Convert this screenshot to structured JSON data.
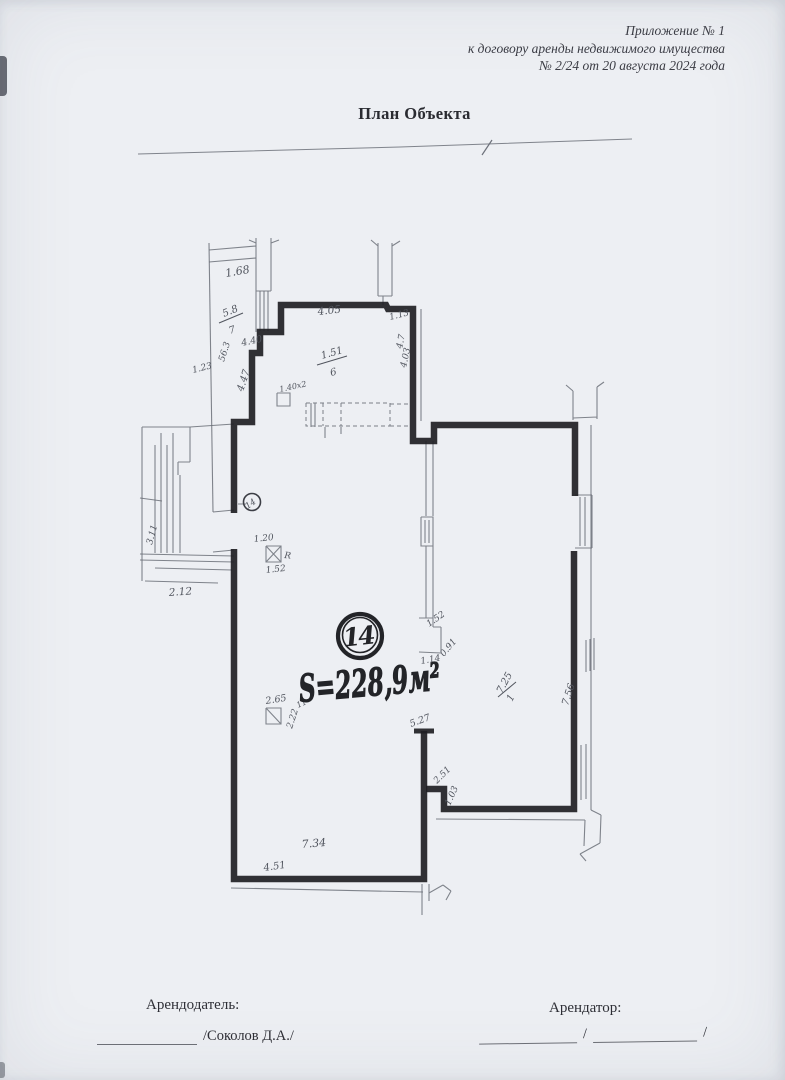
{
  "header": {
    "line1": "Приложение № 1",
    "line2": "к договору аренды недвижимого имущества",
    "line3": "№  2/24 от 20 августа 2024 года"
  },
  "title": "План Объекта",
  "plan": {
    "room_number": "14",
    "small_mark": "14",
    "area_label": "S=228,9м²",
    "labels": [
      {
        "text": "1.68"
      },
      {
        "text": "5.8"
      },
      {
        "text": "7"
      },
      {
        "text": "56.3"
      },
      {
        "text": "4.40"
      },
      {
        "text": "4.47"
      },
      {
        "text": "4.05"
      },
      {
        "text": "1.13"
      },
      {
        "text": "4.7"
      },
      {
        "text": "4.03"
      },
      {
        "text": "1.51"
      },
      {
        "text": "6"
      },
      {
        "text": "1.40х2"
      },
      {
        "text": "1.20"
      },
      {
        "text": "1.52"
      },
      {
        "text": "R"
      },
      {
        "text": "2.12"
      },
      {
        "text": "3.11"
      },
      {
        "text": "1.23"
      },
      {
        "text": "2.65"
      },
      {
        "text": "2.22"
      },
      {
        "text": "11"
      },
      {
        "text": "7.34"
      },
      {
        "text": "4.51"
      },
      {
        "text": "5.27"
      },
      {
        "text": "2.51"
      },
      {
        "text": "1.03"
      },
      {
        "text": "1.52"
      },
      {
        "text": "0.91"
      },
      {
        "text": "1.14"
      },
      {
        "text": "7.25"
      },
      {
        "text": "1"
      },
      {
        "text": "7.56"
      }
    ]
  },
  "footer": {
    "landlord_label": "Арендодатель:",
    "landlord_sign": "/Соколов Д.А./",
    "tenant_label": "Арендатор:",
    "tenant_slash1": "/",
    "tenant_slash2": "/"
  }
}
